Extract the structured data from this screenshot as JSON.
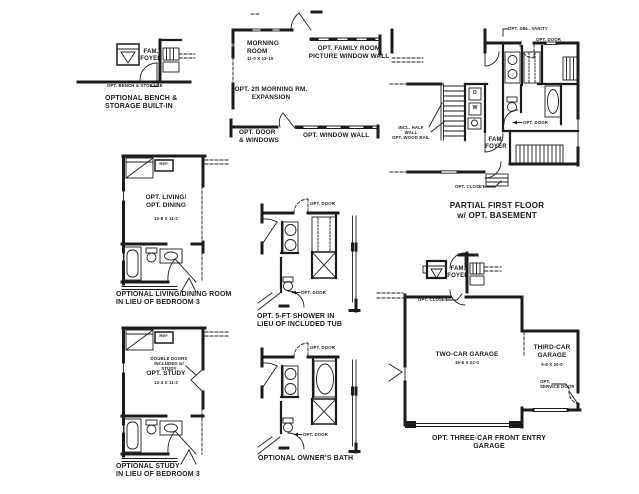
{
  "sheet": {
    "background": "#ffffff",
    "ink": "#1c1c1c"
  },
  "plans": {
    "bench": {
      "room": "FAM.\nFOYER",
      "callout": "OPT. BENCH & STORAGE",
      "caption": "OPTIONAL BENCH &\nSTORAGE BUILT-IN"
    },
    "morning": {
      "room": "MORNING\nROOM",
      "room_dim": "11-0 X 12-10",
      "picture_window": "OPT. FAMILY ROOM\nPICTURE WINDOW WALL",
      "expansion": "OPT. 2ft MORNING RM.\nEXPANSION",
      "door_windows": "OPT. DOOR\n& WINDOWS",
      "window_wall": "OPT. WINDOW WALL"
    },
    "first_floor": {
      "dbl_vanity": "OPT. DBL. VANITY",
      "opt_door_top": "OPT. DOOR",
      "dryer": "D",
      "washer": "W",
      "half_wall": "INCL. HALF WALL\nOPT. WOOD RAIL",
      "foyer": "FAM.\nFOYER",
      "opt_door_mid": "OPT. DOOR",
      "opt_closet": "OPT. CLOSET",
      "caption": "PARTIAL FIRST FLOOR\nw/ OPT. BASEMENT"
    },
    "living_dining": {
      "ref": "REF.",
      "room": "OPT. LIVING/\nOPT. DINING",
      "room_dim": "12-8 X 11-2",
      "caption": "OPTIONAL LIVING/DINING ROOM\nIN LIEU OF BEDROOM 3"
    },
    "shower": {
      "opt_door_top": "OPT. DOOR",
      "opt_door_bottom": "OPT. DOOR",
      "caption": "OPT. 5-FT SHOWER IN\nLIEU OF INCLUDED TUB"
    },
    "study": {
      "ref": "REF.",
      "double_doors": "DOUBLE DOORS\nINCLUDED w/ STUDY",
      "room": "OPT. STUDY",
      "room_dim": "12-4 X 11-2",
      "caption": "OPTIONAL STUDY\nIN LIEU OF BEDROOM 3"
    },
    "owners_bath": {
      "opt_door_top": "OPT. DOOR",
      "opt_door_bottom": "OPT. DOOR",
      "caption": "OPTIONAL OWNER'S BATH"
    },
    "garage": {
      "foyer": "FAM.\nFOYER",
      "opt_closet": "OPT. CLOSET",
      "two_car": "TWO-CAR GARAGE",
      "two_car_dim": "19-6 X 22-0",
      "third_car": "THIRD-CAR\nGARAGE",
      "third_car_dim": "9-8 X 20-0",
      "service_door": "OPT.\nSERVICE DOOR",
      "caption": "OPT. THREE-CAR FRONT ENTRY GARAGE"
    }
  }
}
